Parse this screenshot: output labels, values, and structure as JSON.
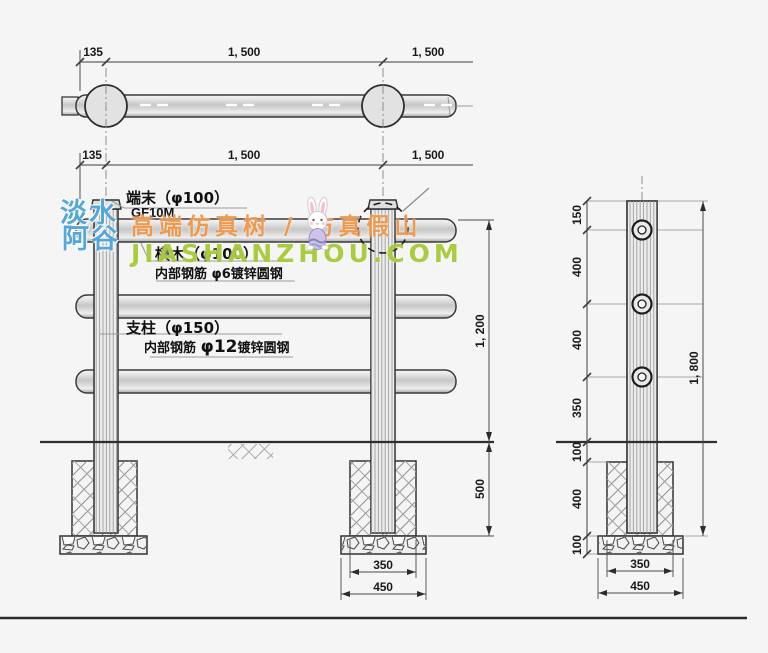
{
  "watermark": {
    "logo_line1": "淡水",
    "logo_line2": "阿谷",
    "tagline": "高端仿真树 / 仿真假山",
    "site": "JIASHANZHOU.COM",
    "logo_color": "#55a7da",
    "tagline_color": "#ef9140",
    "site_color": "#a4c937"
  },
  "plan_view": {
    "dims": [
      "135",
      "1, 500",
      "1, 500"
    ]
  },
  "elevation": {
    "dims_top": [
      "135",
      "1, 500",
      "1, 500"
    ],
    "labels": {
      "end_cap": "端末（φ100）",
      "model": "GF10M",
      "rail": "横木（φ100）",
      "rail_rebar": "内部钢筋 φ6镀锌圆钢",
      "post": "支柱（φ150）",
      "post_rebar_prefix": "内部钢筋",
      "post_rebar_size": "φ12",
      "post_rebar_suffix": "镀锌圆钢"
    },
    "dim_height": "1, 200",
    "dim_embed": "500",
    "dim_footing_width": "350",
    "dim_base_width": "450"
  },
  "side_view": {
    "dim_chain": [
      "150",
      "400",
      "400",
      "350",
      "100",
      "400",
      "100"
    ],
    "dim_total": "1, 800",
    "dim_footing_width": "350",
    "dim_base_width": "450"
  }
}
